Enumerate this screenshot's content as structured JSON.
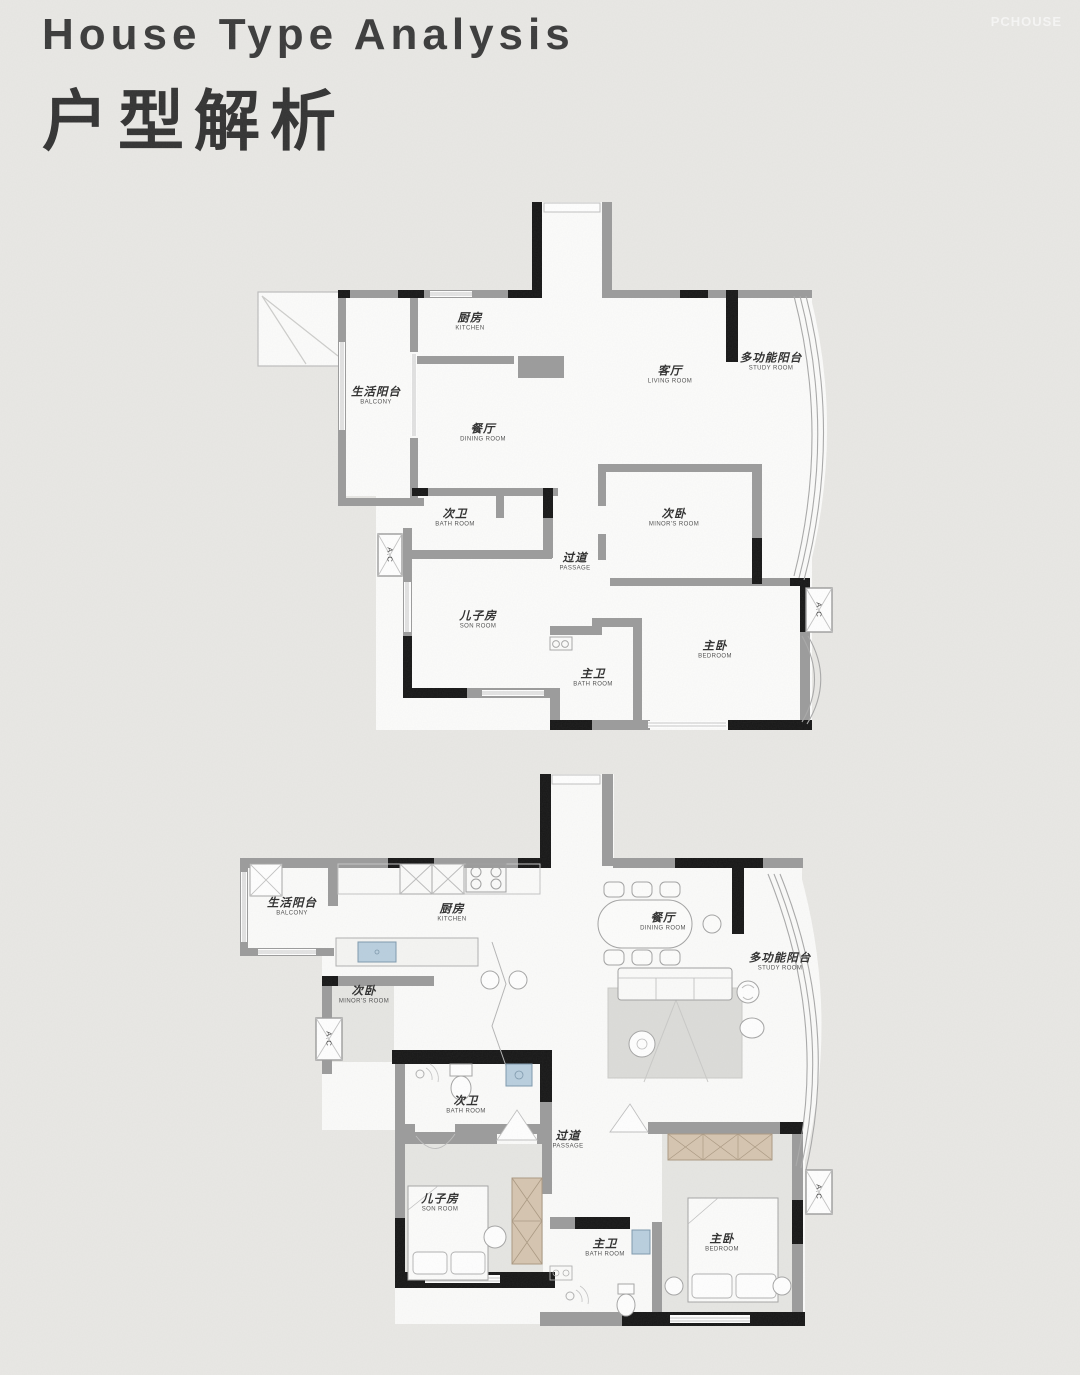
{
  "header": {
    "title_en": "House Type Analysis",
    "title_zh": "户型解析"
  },
  "watermark": "PCHOUSE",
  "colors": {
    "background": "#e9e8e5",
    "wall_gray": "#9b9b9b",
    "wall_black": "#161616",
    "wardrobe_tan": "#d6c5b0",
    "sink_blue": "#b9cfdf",
    "label_text": "#2d2d2d"
  },
  "plans": {
    "original": {
      "ac_label": "A.C",
      "rooms": [
        {
          "id": "kitchen",
          "zh": "厨房",
          "en": "KITCHEN"
        },
        {
          "id": "living",
          "zh": "客厅",
          "en": "LIVING ROOM"
        },
        {
          "id": "study",
          "zh": "多功能阳台",
          "en": "STUDY ROOM"
        },
        {
          "id": "balcony",
          "zh": "生活阳台",
          "en": "BALCONY"
        },
        {
          "id": "dining",
          "zh": "餐厅",
          "en": "DINING ROOM"
        },
        {
          "id": "bath2",
          "zh": "次卫",
          "en": "BATH ROOM"
        },
        {
          "id": "minor",
          "zh": "次卧",
          "en": "MINOR'S ROOM"
        },
        {
          "id": "passage",
          "zh": "过道",
          "en": "PASSAGE"
        },
        {
          "id": "son",
          "zh": "儿子房",
          "en": "SON ROOM"
        },
        {
          "id": "bath1",
          "zh": "主卫",
          "en": "BATH ROOM"
        },
        {
          "id": "bedroom",
          "zh": "主卧",
          "en": "BEDROOM"
        }
      ]
    },
    "furnished": {
      "ac_label": "A.C",
      "rooms": [
        {
          "id": "kitchen",
          "zh": "厨房",
          "en": "KITCHEN"
        },
        {
          "id": "living",
          "zh": "客厅",
          "en": "LIVING ROOM"
        },
        {
          "id": "study",
          "zh": "多功能阳台",
          "en": "STUDY ROOM"
        },
        {
          "id": "balcony",
          "zh": "生活阳台",
          "en": "BALCONY"
        },
        {
          "id": "dining",
          "zh": "餐厅",
          "en": "DINING ROOM"
        },
        {
          "id": "bath2",
          "zh": "次卫",
          "en": "BATH ROOM"
        },
        {
          "id": "minor",
          "zh": "次卧",
          "en": "MINOR'S ROOM"
        },
        {
          "id": "passage",
          "zh": "过道",
          "en": "PASSAGE"
        },
        {
          "id": "son",
          "zh": "儿子房",
          "en": "SON ROOM"
        },
        {
          "id": "bath1",
          "zh": "主卫",
          "en": "BATH ROOM"
        },
        {
          "id": "bedroom",
          "zh": "主卧",
          "en": "BEDROOM"
        }
      ]
    }
  }
}
